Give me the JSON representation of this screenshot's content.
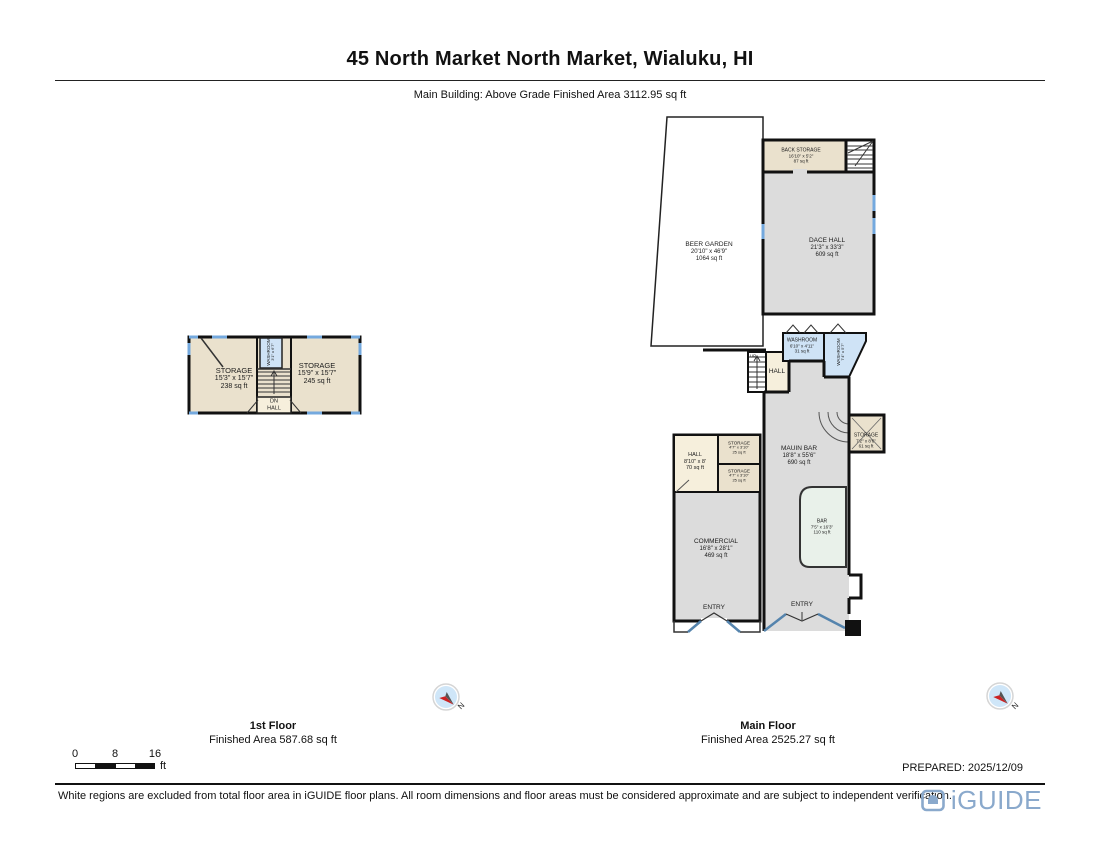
{
  "header": {
    "title": "45 North Market North Market, Wialuku, HI",
    "subtitle": "Main Building: Above Grade Finished Area 3112.95 sq ft"
  },
  "floor1": {
    "caption": "1st Floor",
    "finished_area": "Finished Area 587.68 sq ft",
    "rooms": {
      "storage_west": {
        "name": "STORAGE",
        "dims": "15'3\" x 15'7\"",
        "area": "238 sq ft"
      },
      "storage_east": {
        "name": "STORAGE",
        "dims": "15'9\" x 15'7\"",
        "area": "245 sq ft"
      },
      "washroom": {
        "name": "WASHROOM",
        "dims": "3'1\" x 6'7\""
      },
      "stair_label": {
        "line1": "DN",
        "line2": "HALL"
      }
    }
  },
  "main_floor": {
    "caption": "Main Floor",
    "finished_area": "Finished Area 2525.27 sq ft",
    "rooms": {
      "beer_garden": {
        "name": "BEER GARDEN",
        "dims": "20'10\" x 46'9\"",
        "area": "1064 sq ft"
      },
      "back_storage": {
        "name": "BACK STORAGE",
        "dims": "16'10\" x 5'2\"",
        "area": "87 sq ft"
      },
      "dace_hall": {
        "name": "DACE HALL",
        "dims": "21'3\" x 33'3\"",
        "area": "609 sq ft"
      },
      "washroom": {
        "name": "WASHROOM",
        "dims": "6'10\" x 4'11\"",
        "area": "31 sq ft"
      },
      "washroom_side": {
        "name": "WASHROOM",
        "dims": "7'4\" x 5'7\""
      },
      "hall_center": {
        "name": "HALL"
      },
      "stair_label": {
        "name": "UP"
      },
      "mauin_bar": {
        "name": "MAUIN BAR",
        "dims": "18'8\" x 55'6\"",
        "area": "690 sq ft"
      },
      "storage_side": {
        "name": "STORAGE",
        "dims": "7'2\" x 8'6\"",
        "area": "61 sq ft"
      },
      "hall_west": {
        "name": "HALL",
        "dims": "8'10\" x 8'",
        "area": "70 sq ft"
      },
      "storage_a": {
        "name": "STORAGE",
        "dims": "4'7\" x 3'10\"",
        "area": "25 sq ft"
      },
      "storage_b": {
        "name": "STORAGE",
        "dims": "4'7\" x 3'10\"",
        "area": "25 sq ft"
      },
      "commercial": {
        "name": "COMMERCIAL",
        "dims": "16'8\" x 28'1\"",
        "area": "469 sq ft"
      },
      "bar": {
        "name": "BAR",
        "dims": "7'5\" x 16'3\"",
        "area": "110 sq ft"
      },
      "entry_left": {
        "name": "ENTRY"
      },
      "entry_right": {
        "name": "ENTRY"
      }
    }
  },
  "compass": {
    "label": "N"
  },
  "scale_bar": {
    "tick_0": "0",
    "tick_8": "8",
    "tick_16": "16",
    "unit": "ft"
  },
  "footer": {
    "prepared": "PREPARED: 2025/12/09",
    "disclaimer": "White regions are excluded from total floor area in iGUIDE floor plans. All room dimensions and floor areas must be considered approximate and are subject to independent verification.",
    "brand": "iGUIDE"
  },
  "colors": {
    "wall": "#111111",
    "room_tan": "#eae1cd",
    "room_gray": "#dcdcdc",
    "room_blue": "#cfe3f6",
    "room_cream": "#f6efdc",
    "room_mint": "#e9f1ea",
    "window_blue": "#74a9de",
    "door_blue": "#5584ad",
    "logo_blue": "#8aa9cc",
    "compass_red": "#cc2222"
  }
}
